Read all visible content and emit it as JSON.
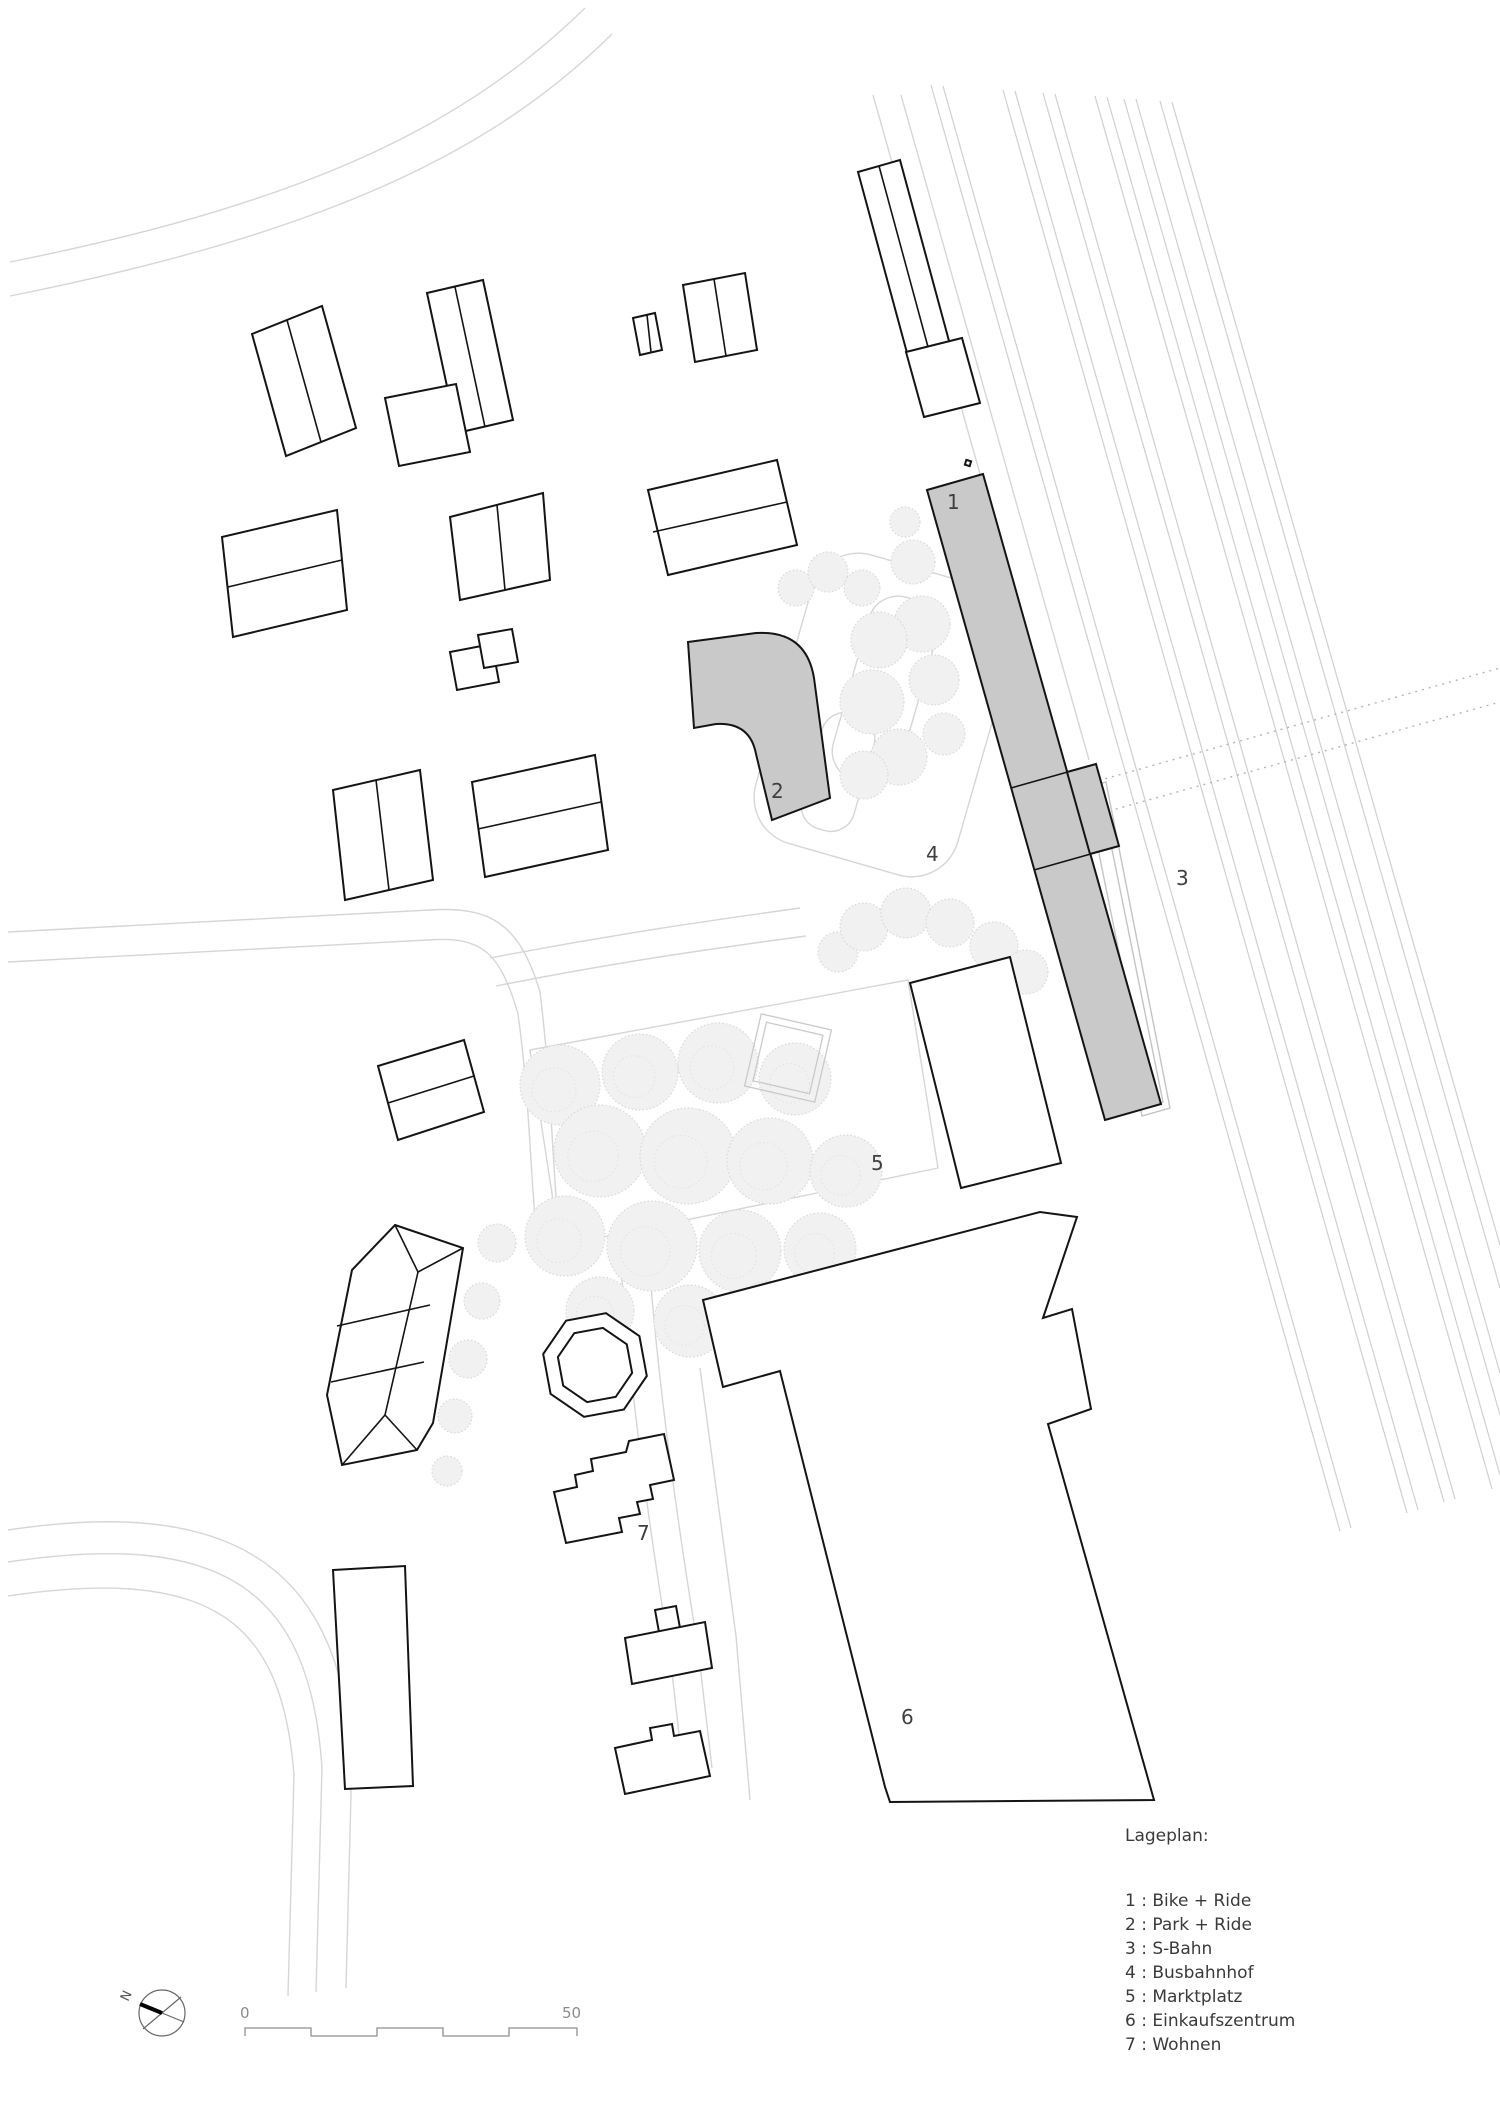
{
  "page": {
    "background": "#ffffff",
    "type": "architectural site plan"
  },
  "colors": {
    "building_fill": "#ffffff",
    "building_stroke": "#141414",
    "highlight_fill": "#c9c9c9",
    "road": "#d6d6d6",
    "tree": "#d8d8d8",
    "rail": "#cfcfcf",
    "label": "#3f3f3f",
    "legend_text": "#3a3a3a",
    "scale_text": "#8a8a8a"
  },
  "legend": {
    "heading": "Lageplan:",
    "items": [
      "1 : Bike + Ride",
      "2 : Park + Ride",
      "3 : S-Bahn",
      "4 : Busbahnhof",
      "5 : Marktplatz",
      "6 : Einkaufszentrum",
      "7 : Wohnen"
    ]
  },
  "plan_labels": [
    {
      "text": "1"
    },
    {
      "text": "2"
    },
    {
      "text": "3"
    },
    {
      "text": "4"
    },
    {
      "text": "5"
    },
    {
      "text": "6"
    },
    {
      "text": "7"
    }
  ],
  "compass": {
    "label": "N"
  },
  "scale_bar": {
    "start_label": "0",
    "end_label": "50"
  }
}
